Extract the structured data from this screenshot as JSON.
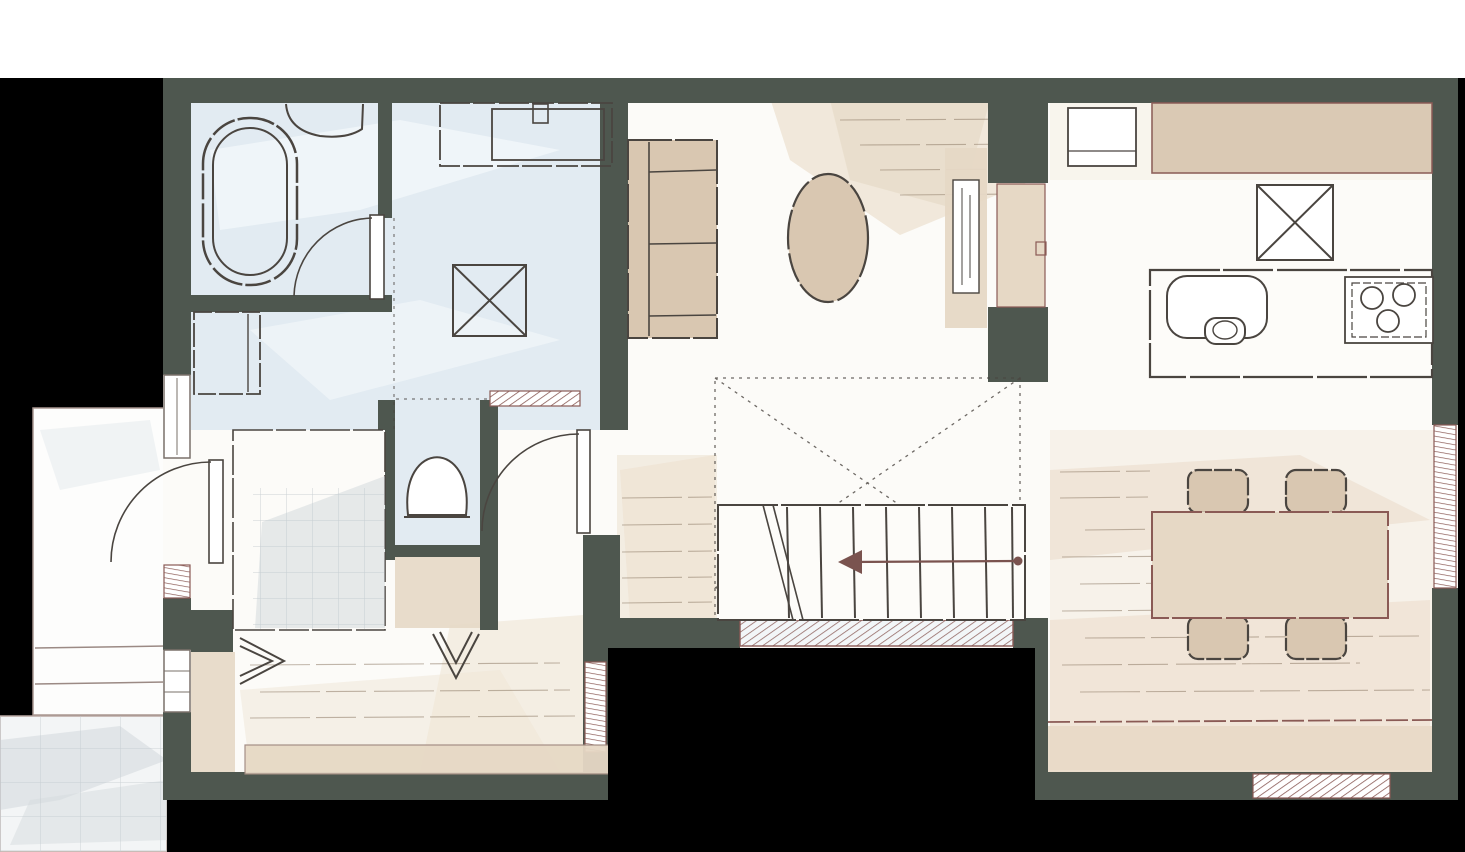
{
  "app": {
    "type": "floor-plan-image",
    "style": "hand-drawn-watercolor-plan",
    "visible_text_labels": []
  },
  "colors": {
    "background": "#000000",
    "paper": "#ffffff",
    "floor": "#fcfbf8",
    "wall": "#4e574f",
    "ink": "#4a4540",
    "hatch": "#8a5a55",
    "wet_floor": "#e2ebf2",
    "wet_streak": "#f2f7fa",
    "beige": "#d9c7b1",
    "beige_light": "#e6d8c5",
    "wood_wash": "#eadcc8",
    "wood_line": "#8f7c68",
    "tile_fill": "#f3f5f6",
    "tile_line": "#c2c9ce",
    "arrow": "#7a534f",
    "window_frame": "#7a716a"
  },
  "plan": {
    "rooms": [
      {
        "name": "bathroom",
        "floor": "wet-blue",
        "furniture": [
          "bathtub",
          "corner-counter"
        ],
        "door": "swing"
      },
      {
        "name": "washroom",
        "floor": "wet-blue",
        "furniture": [
          "vanity-sink",
          "washing-machine-pan"
        ],
        "door": "swing"
      },
      {
        "name": "laundry-nook",
        "floor": "wet-blue",
        "furniture": [
          "storage-cabinet"
        ]
      },
      {
        "name": "toilet",
        "floor": "wet-blue",
        "furniture": [
          "toilet"
        ],
        "door": "sliding-hatched"
      },
      {
        "name": "tiled-closet",
        "floor": "gray-tile",
        "door": "bifold-chevron"
      },
      {
        "name": "closet",
        "floor": "beige",
        "door": "bifold-chevron"
      },
      {
        "name": "entrance-hall",
        "floor": "wood",
        "furniture": [
          "step-board"
        ]
      },
      {
        "name": "living-room",
        "floor": "white-wood",
        "furniture": [
          "sofa",
          "oval-coffee-table",
          "tv-board",
          "wall-niche"
        ]
      },
      {
        "name": "kitchen",
        "floor": "white",
        "furniture": [
          "counter-cupboard",
          "appliance-box",
          "refrigerator-space",
          "island-counter",
          "sink-with-faucet",
          "cooktop-3-burner"
        ]
      },
      {
        "name": "dining-room",
        "floor": "wood",
        "furniture": [
          "dining-table",
          "chair",
          "chair",
          "chair",
          "chair"
        ]
      },
      {
        "name": "stair-hall",
        "floor": "wood",
        "furniture": [
          "staircase-8-treads",
          "up-direction-arrow",
          "void-dashed-x"
        ]
      }
    ],
    "outdoor": [
      {
        "name": "porch",
        "features": [
          "entrance-door-swing",
          "two-steps"
        ]
      },
      {
        "name": "approach",
        "floor": "gray-tile"
      },
      {
        "name": "veranda-strip",
        "floor": "beige"
      }
    ],
    "symbols": [
      "door-swing-arc",
      "bifold-door-chevron",
      "window-double-line",
      "hatched-opening",
      "void-dashed-x",
      "stair-direction-arrow",
      "x-marked-appliance-space"
    ]
  }
}
